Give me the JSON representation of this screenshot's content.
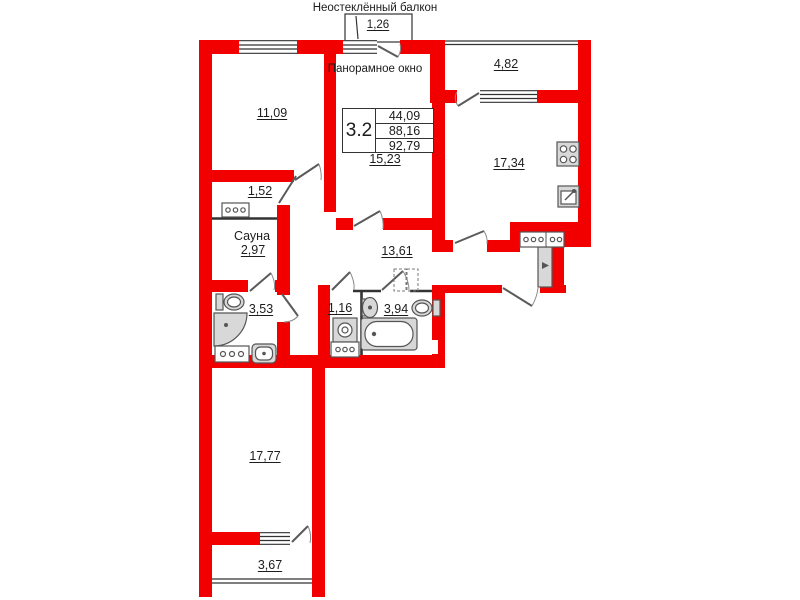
{
  "colors": {
    "wall": "#f20000",
    "line": "#333333",
    "fixture_fill": "#d8d8d8",
    "fixture_stroke": "#555555"
  },
  "labels": {
    "unglazed_balcony": "Неостеклённый балкон",
    "panoramic_window": "Панорамное окно",
    "sauna_name": "Сауна"
  },
  "stats_box": {
    "plan_type": "3.2",
    "rows": [
      "44,09",
      "88,16",
      "92,79"
    ]
  },
  "areas": {
    "balcony_top": "1,26",
    "bedroom_top_left": "11,09",
    "loggia_right": "4,82",
    "kitchen": "17,34",
    "living_room": "15,23",
    "corridor_small": "1,52",
    "sauna": "2,97",
    "bathroom_shower": "3,53",
    "hallway": "13,61",
    "laundry": "1,16",
    "bathroom_main": "3,94",
    "bedroom_bottom": "17,77",
    "balcony_bottom": "3,67"
  },
  "icons": [
    "stove-icon",
    "kitchen-sink-icon",
    "toilet-icon",
    "corner-shower-icon",
    "sink-icon",
    "bathtub-icon",
    "washing-machine-icon",
    "wardrobe-icon",
    "entrance-door-icon",
    "door-swing-icon",
    "window-icon"
  ]
}
